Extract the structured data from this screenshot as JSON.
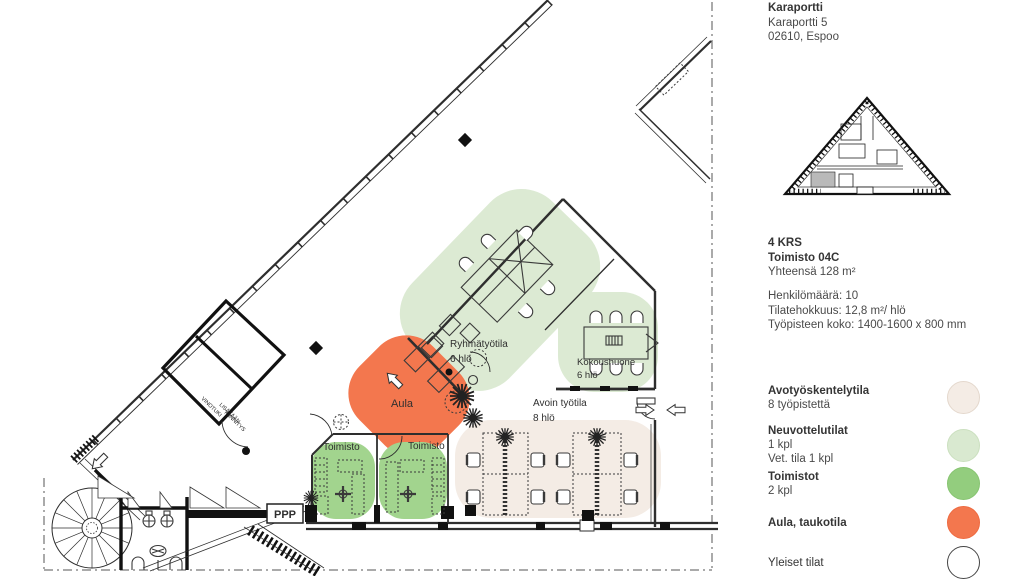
{
  "header": {
    "name": "Karaportti",
    "street": "Karaportti 5",
    "city": "02610, Espoo"
  },
  "unit_info": {
    "floor": "4 KRS",
    "unit": "Toimisto 04C",
    "total_area": "Yhteensä 128 m²"
  },
  "metrics": {
    "headcount": "Henkilömäärä: 10",
    "efficiency": "Tilatehokkuus:  12,8 m²/ hlö",
    "workstation_size": "Työpisteen koko: 1400-1600 x 800 mm"
  },
  "legend": {
    "items": [
      {
        "title": "Avotyöskentelytila",
        "lines": [
          "8 työpistettä"
        ],
        "color": "#f4ece5",
        "border": "#e4d8cd"
      },
      {
        "title": "Neuvottelutilat",
        "lines": [
          "1 kpl",
          "Vet. tila 1 kpl"
        ],
        "color": "#d9e9d0",
        "border": "#cbe0bf"
      },
      {
        "title": "Toimistot",
        "lines": [
          "2 kpl"
        ],
        "color": "#93cd7e",
        "border": "#87c471"
      },
      {
        "title": "Aula, taukotila",
        "lines": [],
        "color": "#f3774e",
        "border": "#ee6a40"
      },
      {
        "title": "Yleiset tilat",
        "lines": [],
        "color": "#ffffff",
        "border": "#454545"
      }
    ]
  },
  "floor_plan": {
    "rooms": {
      "group_room": {
        "name": "Ryhmätyötila",
        "capacity": "6 hlö"
      },
      "meeting_room": {
        "name": "Kokoushuone",
        "capacity": "6 hlö"
      },
      "open_office": {
        "name": "Avoin työtila",
        "capacity": "8 hlö"
      },
      "lobby": {
        "name": "Aula"
      },
      "office_1": {
        "name": "Toimisto"
      },
      "office_2": {
        "name": "Toimisto"
      }
    },
    "annotations": {
      "brace": "VINOTUKI",
      "added_1": "LISÄTÄÄN",
      "added_2": "KIINNITYS",
      "ppp": "PPP"
    }
  },
  "colors": {
    "open": "#f4ece5",
    "meeting": "#dcead3",
    "office": "#a2d48e",
    "lobby": "#f3774e",
    "line": "#2e2e2e"
  }
}
